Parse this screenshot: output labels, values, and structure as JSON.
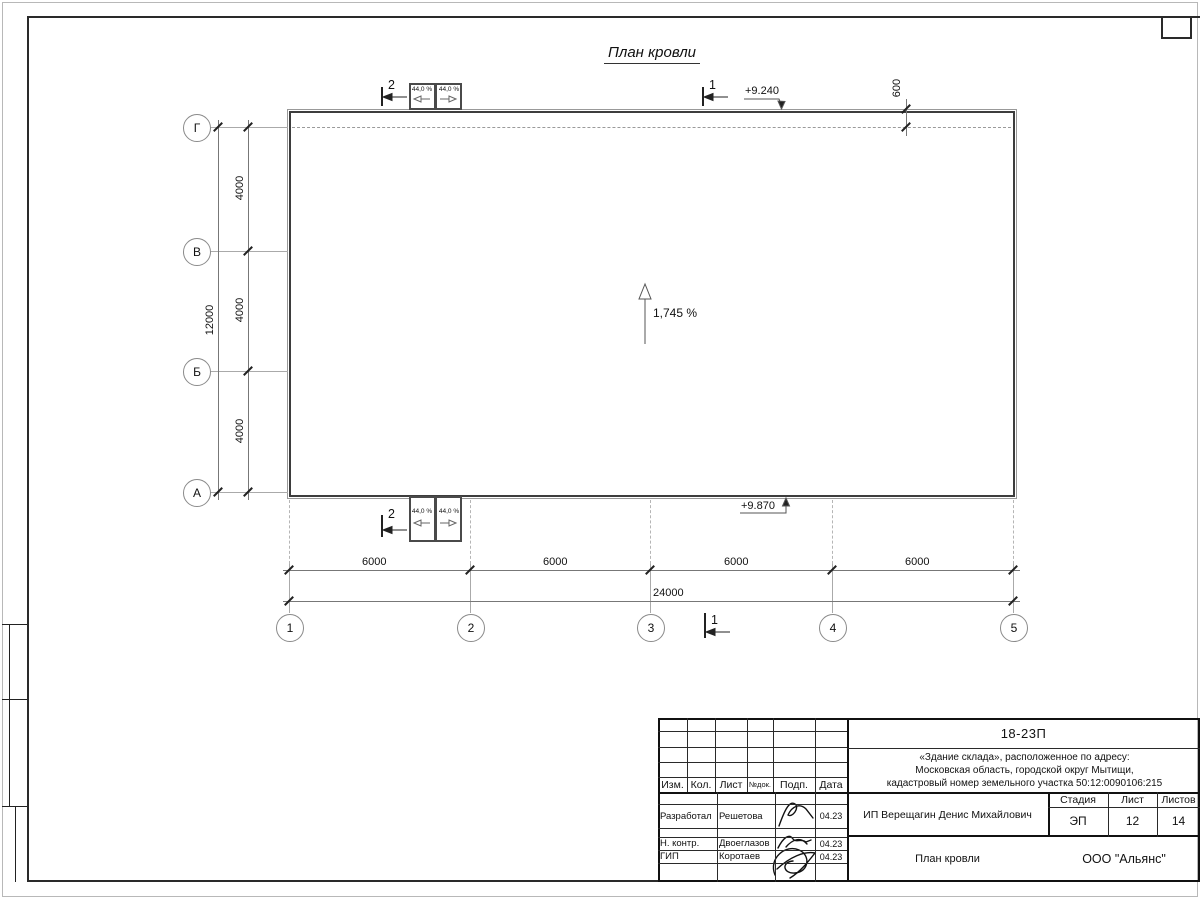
{
  "sheet_title": "План кровли",
  "drawing": {
    "axes": {
      "rows": [
        "Г",
        "В",
        "Б",
        "А"
      ],
      "cols": [
        "1",
        "2",
        "3",
        "4",
        "5"
      ]
    },
    "dims": {
      "row_spacing": [
        "4000",
        "4000",
        "4000"
      ],
      "row_total": "12000",
      "col_spacing": [
        "6000",
        "6000",
        "6000",
        "6000"
      ],
      "col_total": "24000",
      "overhang": "600"
    },
    "elevations": {
      "top": "+9.240",
      "bottom": "+9.870"
    },
    "slopes": {
      "main": "1,745 %",
      "local": "44,0 %"
    },
    "cuts": [
      "2",
      "1"
    ]
  },
  "titleblock": {
    "code": "18-23П",
    "object_lines": [
      "«Здание склада», расположенное по адресу:",
      "Московская область, городской округ Мытищи,",
      "кадастровый номер земельного участка 50:12:0090106:215"
    ],
    "header_cols": [
      "Изм.",
      "Кол.",
      "Лист",
      "№док.",
      "Подп.",
      "Дата"
    ],
    "sign_rows": [
      {
        "role": "Разработал",
        "name": "Решетова",
        "date": "04.23"
      },
      {
        "role": "Н. контр.",
        "name": "Двоеглазов",
        "date": "04.23"
      },
      {
        "role": "ГИП",
        "name": "Коротаев",
        "date": "04.23"
      }
    ],
    "client": "ИП Верещагин Денис Михайлович",
    "doc_title": "План кровли",
    "org": "ООО \"Альянс\"",
    "stage": {
      "label": "Стадия",
      "value": "ЭП"
    },
    "sheet": {
      "label": "Лист",
      "value": "12"
    },
    "sheets": {
      "label": "Листов",
      "value": "14"
    }
  }
}
